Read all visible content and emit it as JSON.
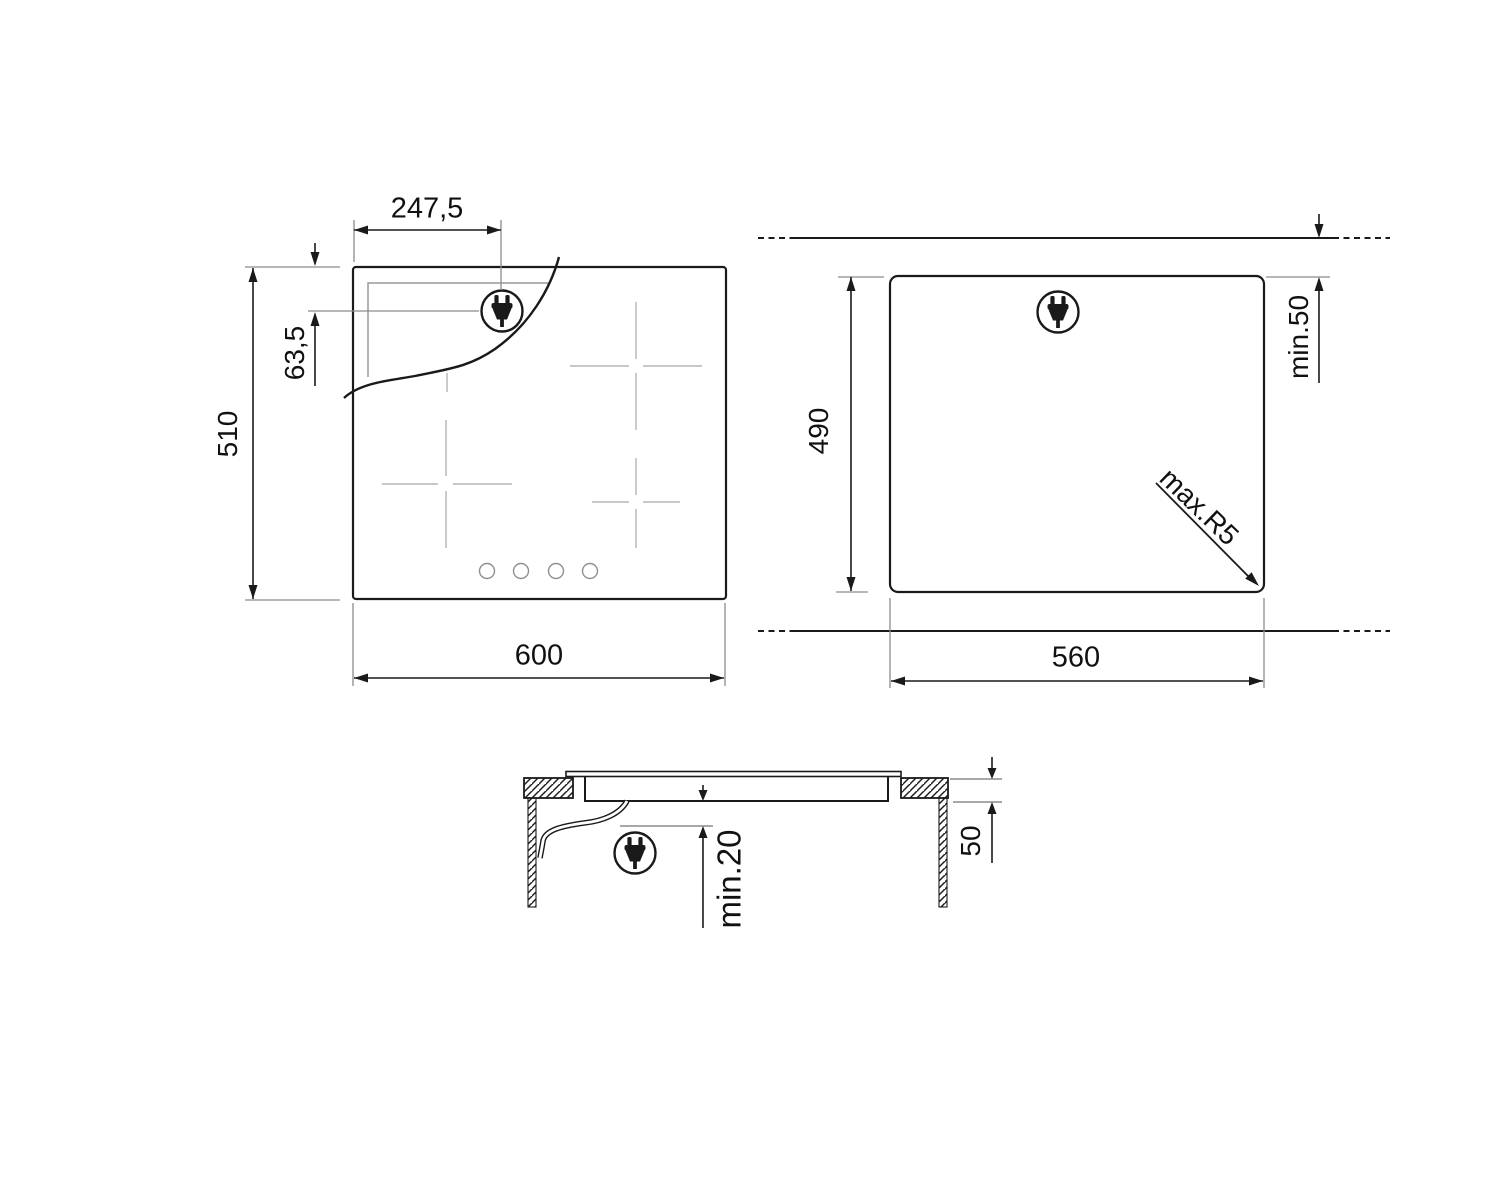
{
  "drawing": {
    "type": "appliance-installation-diagram",
    "colors": {
      "line": "#1a1a1a",
      "dim_gray": "#8c8c8c",
      "zone_gray": "#b5b5b5"
    },
    "labels": {
      "plug_offset_x": "247,5",
      "plug_offset_y": "63,5",
      "hob_depth": "510",
      "hob_width": "600",
      "cutout_depth": "490",
      "rear_clearance": "min.50",
      "cutout_width": "560",
      "corner_radius": "max.R5",
      "bottom_clearance": "min.20",
      "recess_depth": "50"
    },
    "icons": {
      "plug": "power-plug-icon"
    },
    "views": {
      "plan": {
        "title": "hob top view",
        "width_mm": "600",
        "depth_mm": "510"
      },
      "cutout": {
        "title": "worktop cutout",
        "width_mm": "560",
        "depth_mm": "490"
      },
      "section": {
        "title": "side section",
        "recess_mm": "50",
        "clearance_mm": "min.20"
      }
    }
  }
}
